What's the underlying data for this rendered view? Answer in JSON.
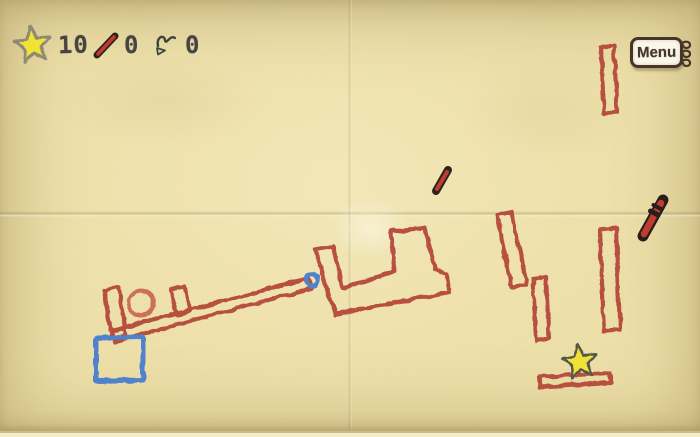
{
  "hud": {
    "stars_count": "10",
    "pencil_count": "0",
    "scribble_count": "0",
    "icons": [
      "star-icon",
      "pencil-slash-icon",
      "scribble-icon"
    ]
  },
  "menu": {
    "label": "Menu"
  },
  "colors": {
    "paper": "#eee0a9",
    "crayon_red": "#b5463a",
    "crayon_red_light": "#cd6e5c",
    "crayon_blue": "#4d82cf",
    "star_yellow": "#f0e335",
    "star_outline": "#55544a",
    "hud_star_outline": "#8d8a79",
    "ink_dark": "#46362a",
    "hud_text": "#47463e",
    "note_paper": "#fbf7e9"
  },
  "scene": {
    "objects": [
      "lever-arm-with-cup",
      "ball-in-cup",
      "pivot-pin",
      "boot-platform",
      "blue-square",
      "tilted-plank",
      "short-plank",
      "tall-plank",
      "top-right-plank",
      "goal-star",
      "goal-platform",
      "small-pencil",
      "big-pencil"
    ]
  }
}
